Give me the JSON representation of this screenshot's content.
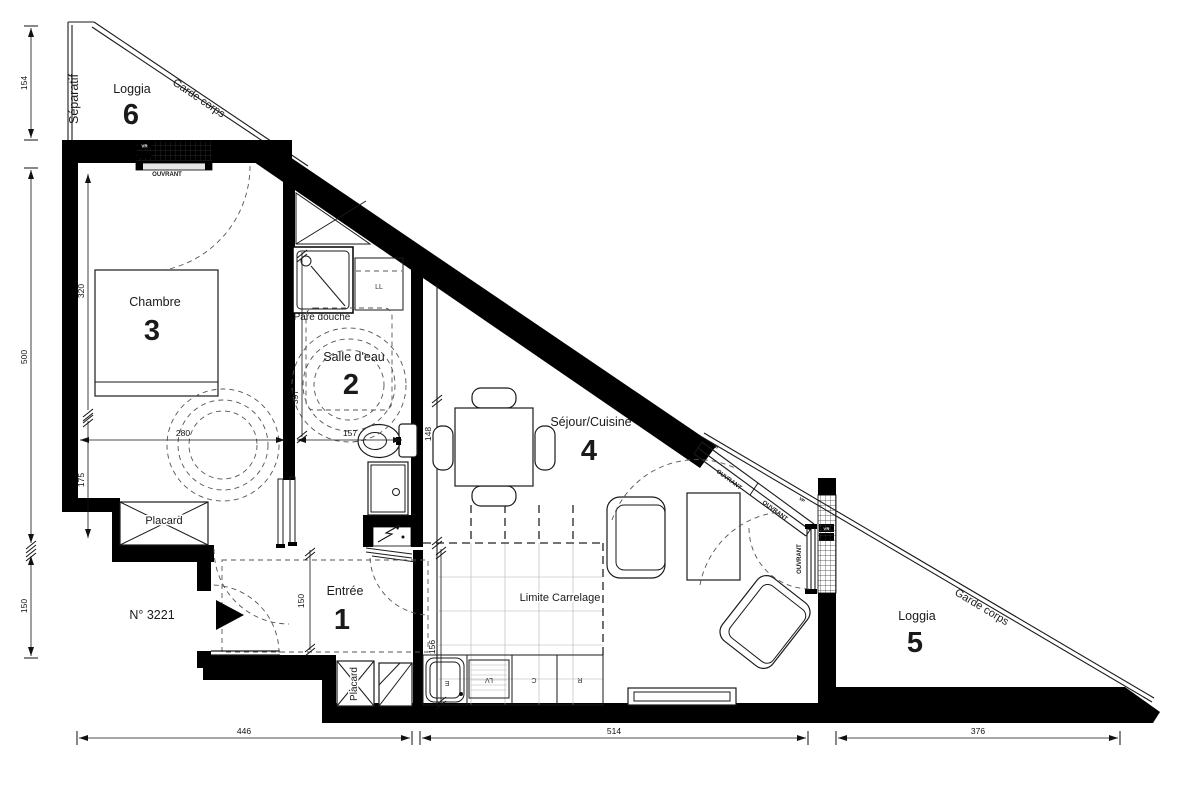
{
  "document": {
    "type": "architectural-floor-plan",
    "background": "#ffffff"
  },
  "colors": {
    "wall": "#000000",
    "line": "#1a1a1a",
    "dashed": "#555555",
    "text": "#1a1a1a"
  },
  "rooms": {
    "entree": {
      "name": "Entrée",
      "num": "1"
    },
    "salle_deau": {
      "name": "Salle d'eau",
      "num": "2"
    },
    "chambre": {
      "name": "Chambre",
      "num": "3"
    },
    "sejour_cuisine": {
      "name": "Séjour/Cuisine",
      "num": "4"
    },
    "loggia_5": {
      "name": "Loggia",
      "num": "5"
    },
    "loggia_6": {
      "name": "Loggia",
      "num": "6"
    }
  },
  "labels": {
    "separatif": "Séparatif",
    "garde_corps": "Garde corps",
    "ouvrant": "OUVRANT",
    "vp": "VP",
    "vr": "VR",
    "pare_douche": "Pare douche",
    "limite_carrelage": "Limite Carrelage",
    "placard": "Placard",
    "lave_linge": "LL",
    "lave_vaisselle": "LV",
    "cuisson": "C",
    "refrigerateur": "R",
    "evier": "E",
    "unit_number": "N° 3221"
  },
  "dimensions_cm": {
    "loggia6_height": "154",
    "left_total": "500",
    "left_lower": "150",
    "chambre_length": "320",
    "chambre_lower": "175",
    "chambre_width": "280",
    "salle_deau_length": "397",
    "salle_deau_width": "157",
    "sejour_entry": "148",
    "cuisine_width": "156",
    "entree_length": "150",
    "bottom_left": "446",
    "bottom_middle": "514",
    "bottom_right": "376"
  }
}
